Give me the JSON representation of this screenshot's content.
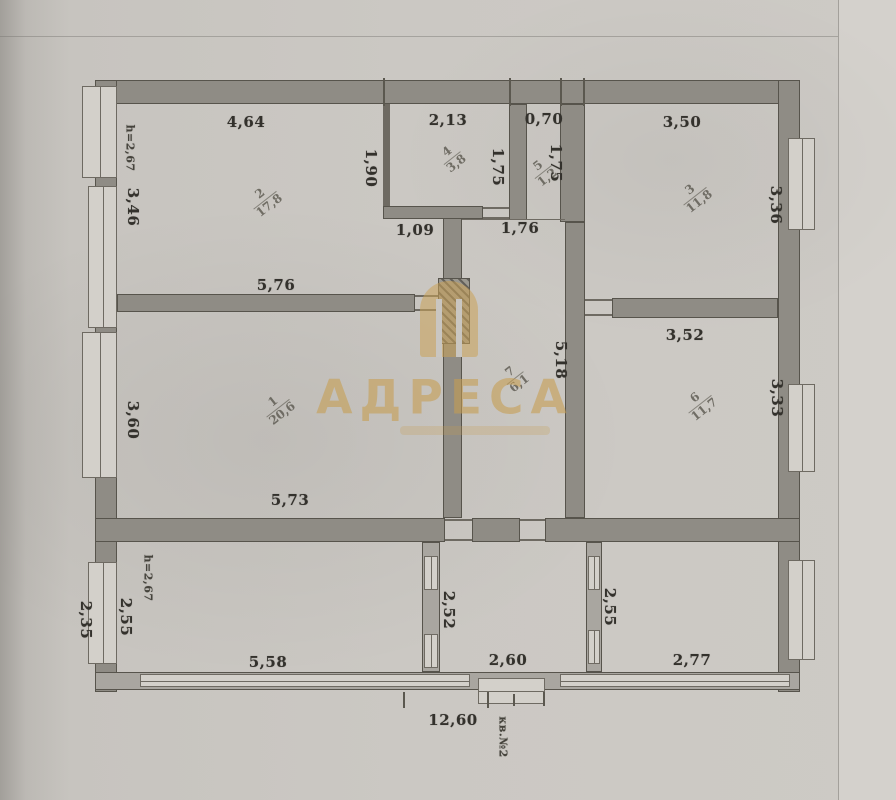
{
  "document": {
    "watermark_title": "АДРЕСА",
    "apartment_note": "кв.№2"
  },
  "rooms": [
    {
      "number": "1",
      "area": "20,6",
      "cx": 278,
      "cy": 408
    },
    {
      "number": "2",
      "area": "17,8",
      "cx": 265,
      "cy": 200
    },
    {
      "number": "3",
      "area": "11,8",
      "cx": 695,
      "cy": 196
    },
    {
      "number": "4",
      "area": "3,8",
      "cx": 452,
      "cy": 158
    },
    {
      "number": "5",
      "area": "1,2",
      "cx": 543,
      "cy": 172
    },
    {
      "number": "6",
      "area": "11,7",
      "cx": 700,
      "cy": 404
    },
    {
      "number": "7",
      "area": "6,1",
      "cx": 515,
      "cy": 378
    }
  ],
  "labels": [
    {
      "kind": "dim",
      "text": "4,64",
      "cx": 246,
      "cy": 122,
      "rot": 0
    },
    {
      "kind": "dim",
      "text": "2,13",
      "cx": 448,
      "cy": 120,
      "rot": 0
    },
    {
      "kind": "dim",
      "text": "0,70",
      "cx": 544,
      "cy": 119,
      "rot": 0
    },
    {
      "kind": "dim",
      "text": "3,50",
      "cx": 682,
      "cy": 122,
      "rot": 0
    },
    {
      "kind": "height",
      "text": "h=2,67",
      "cx": 130,
      "cy": 148,
      "rot": 90
    },
    {
      "kind": "dim",
      "text": "3,46",
      "cx": 133,
      "cy": 207,
      "rot": 90
    },
    {
      "kind": "dim",
      "text": "1,90",
      "cx": 371,
      "cy": 168,
      "rot": 90
    },
    {
      "kind": "dim",
      "text": "1,75",
      "cx": 498,
      "cy": 167,
      "rot": 90
    },
    {
      "kind": "dim",
      "text": "1,75",
      "cx": 556,
      "cy": 163,
      "rot": 90
    },
    {
      "kind": "dim",
      "text": "3,36",
      "cx": 776,
      "cy": 205,
      "rot": 90
    },
    {
      "kind": "dim",
      "text": "1,09",
      "cx": 415,
      "cy": 230,
      "rot": 0
    },
    {
      "kind": "dim",
      "text": "1,76",
      "cx": 520,
      "cy": 228,
      "rot": 0
    },
    {
      "kind": "dim",
      "text": "5,76",
      "cx": 276,
      "cy": 285,
      "rot": 0
    },
    {
      "kind": "dim",
      "text": "3,52",
      "cx": 685,
      "cy": 335,
      "rot": 0
    },
    {
      "kind": "dim",
      "text": "5,18",
      "cx": 561,
      "cy": 360,
      "rot": 90
    },
    {
      "kind": "dim",
      "text": "3,33",
      "cx": 777,
      "cy": 398,
      "rot": 90
    },
    {
      "kind": "dim",
      "text": "3,60",
      "cx": 133,
      "cy": 420,
      "rot": 90
    },
    {
      "kind": "dim",
      "text": "5,73",
      "cx": 290,
      "cy": 500,
      "rot": 0
    },
    {
      "kind": "height",
      "text": "h=2,67",
      "cx": 148,
      "cy": 578,
      "rot": 90
    },
    {
      "kind": "dim",
      "text": "2,35",
      "cx": 86,
      "cy": 620,
      "rot": 90
    },
    {
      "kind": "dim",
      "text": "2,55",
      "cx": 126,
      "cy": 617,
      "rot": 90
    },
    {
      "kind": "dim",
      "text": "5,58",
      "cx": 268,
      "cy": 662,
      "rot": 0
    },
    {
      "kind": "dim",
      "text": "2,52",
      "cx": 449,
      "cy": 610,
      "rot": 90
    },
    {
      "kind": "dim",
      "text": "2,60",
      "cx": 508,
      "cy": 660,
      "rot": 0
    },
    {
      "kind": "dim",
      "text": "2,55",
      "cx": 610,
      "cy": 607,
      "rot": 90
    },
    {
      "kind": "dim",
      "text": "2,77",
      "cx": 692,
      "cy": 660,
      "rot": 0
    },
    {
      "kind": "dim",
      "text": "12,60",
      "cx": 453,
      "cy": 720,
      "rot": 0
    },
    {
      "kind": "note",
      "text": "кв.№2",
      "cx": 503,
      "cy": 737,
      "rot": 90
    }
  ],
  "colors": {
    "wall": "#8f8c85",
    "paper": "#cbc8c3",
    "ink": "#33312c",
    "watermark_gold": "#c69c50"
  }
}
